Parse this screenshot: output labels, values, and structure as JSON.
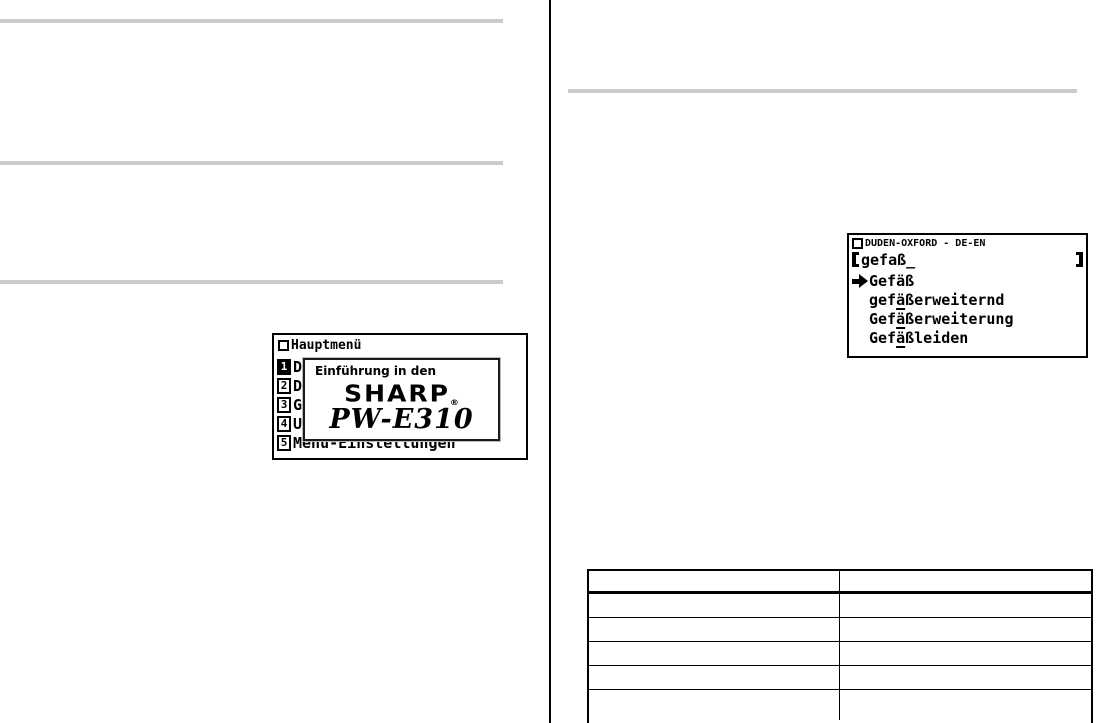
{
  "colors": {
    "paper": "#ffffff",
    "ink": "#000000",
    "gray_rule": "#cbcbcb"
  },
  "icons": {
    "window_square": "window-title-square",
    "arrow_right": "solid-right-arrow",
    "bracket_open": "[",
    "bracket_close": "]"
  },
  "left_lcd": {
    "title": "Hauptmenü",
    "menu_items": [
      {
        "num": "1",
        "text": "D",
        "selected": true
      },
      {
        "num": "2",
        "text": "D",
        "selected": false
      },
      {
        "num": "3",
        "text": "G",
        "selected": false
      },
      {
        "num": "4",
        "text": "U",
        "selected": false
      },
      {
        "num": "5",
        "text": "Menü-Einstellungen",
        "selected": false
      }
    ],
    "popup": {
      "intro": "Einführung in den",
      "brand": "SHARP",
      "registered": "®",
      "model": "PW-E310"
    }
  },
  "right_lcd": {
    "title": "DUDEN-OXFORD - DE-EN",
    "search_value": "gefaß_",
    "results": [
      {
        "pre": "Gefäß",
        "underlined": "",
        "post": "",
        "has_arrow": true
      },
      {
        "pre": "gef",
        "underlined": "ä",
        "post": "ßerweiternd",
        "has_arrow": false
      },
      {
        "pre": "Gef",
        "underlined": "ä",
        "post": "ßerweiterung",
        "has_arrow": false
      },
      {
        "pre": "Gef",
        "underlined": "ä",
        "post": "ßleiden",
        "has_arrow": false
      }
    ]
  },
  "table": {
    "column_count": 2,
    "row_count": 6,
    "cells_empty": true
  }
}
